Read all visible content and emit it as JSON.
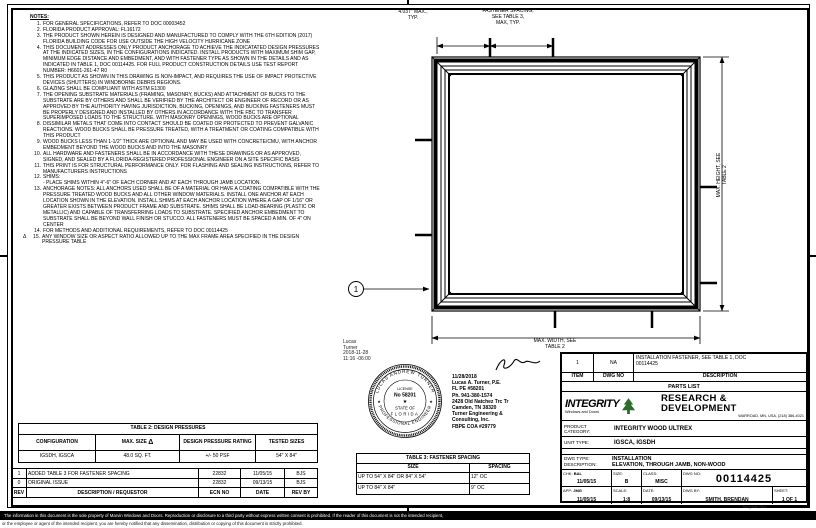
{
  "notes": {
    "title": "NOTES:",
    "items": [
      {
        "num": "1.",
        "text": "FOR GENERAL SPECIFICATIONS, REFER TO DOC 00003452"
      },
      {
        "num": "2.",
        "text": "FLORIDA PRODUCT APPROVAL: FL16172"
      },
      {
        "num": "3.",
        "text": "THE PRODUCT SHOWN HEREIN IS DESIGNED AND MANUFACTURED TO COMPLY WITH THE 6TH EDITION (2017) FLORIDA BUILDING CODE FOR USE OUTSIDE THE HIGH VELOCITY HURRICANE ZONE"
      },
      {
        "num": "4.",
        "text": "THIS DOCUMENT ADDRESSES ONLY PRODUCT ANCHORAGE TO ACHIEVE THE INDICATATED DESIGN PRESSURES AT THE INDICATED SIZES, IN THE CONFIGURATIONS INDICATED. INSTALL PRODUCTS WITH MAXIMUM SHIM GAP, MINIMUM EDGE DISTANCE AND EMBEDMENT, AND WITH FASTENER TYPE AS SHOWN IN THE DETAILS AND AS INDICATED IN TABLE 1, DOC 00114425. FOR FULL PRODUCT CONSTRUCTION DETAILS USE TEST REPORT NUMBER: H6601-261-47 R0"
      },
      {
        "num": "5.",
        "text": "THIS PRODUCT AS SHOWN IN THIS DRAWING IS NON-IMPACT, AND REQUIRES THE USE OF IMPACT PROTECTIVE DEVICES (SHUTTERS) IN WINDBORNE DEBRIS REGIONS."
      },
      {
        "num": "6.",
        "text": "GLAZING SHALL BE COMPLIANT WITH ASTM E1300"
      },
      {
        "num": "7.",
        "text": "THE OPENING SUBSTRATE MATERIALS (FRAMING, MASONRY, BUCKS) AND ATTACHMENT OF BUCKS TO THE SUBSTRATE ARE BY OTHERS AND SHALL BE VERIFIED BY THE ARCHITECT OR ENGINEER OF RECORD OR AS APPROVED BY THE AUTHORITY HAVING JURISDICTION. BUCKING, OPENINGS, AND BUCKING FASTENERS MUST BE PROPERLY DESIGNED AND INSTALLED BY OTHERS IN ACCORDANCE WITH THE FBC TO TRANSFER SUPERIMPOSED LOADS TO THE STRUCTURE. WITH MASONRY OPENINGS, WOOD BUCKS ARE OPTIONAL"
      },
      {
        "num": "8.",
        "text": "DISSIMILAR METALS THAT COME INTO CONTACT SHOULD BE COATED OR PROTECTED TO PREVENT GALVANIC REACTIONS. WOOD BUCKS SHALL BE PRESSURE TREATED, WITH A TREATMENT OR COATING COMPATIBLE WITH THIS PRODUCT"
      },
      {
        "num": "9.",
        "text": "WOOD BUCKS LESS THAN 1-1/2\" THICK ARE OPTIONAL AND MAY BE USED WITH CONCRETE/CMU, WITH ANCHOR EMBEDMENT BEYOND THE WOOD BUCKS AND INTO THE MASONRY"
      },
      {
        "num": "10.",
        "text": "ALL HARDWARE AND FASTENERS SHALL BE IN ACCORDANCE WITH THESE DRAWINGS OR AS APPROVED, SIGNED, AND SEALED BY A FLORIDA-REGISTERED PROFESSIONAL ENGINEER ON A SITE SPECIFIC BASIS"
      },
      {
        "num": "11.",
        "text": "THIS PRINT IS FOR STRUCTURAL PERFORMANCE ONLY. FOR FLASHING AND SEALING INSTRUCTIONS, REFER TO MANUFACTURERS INSTRUCTIONS"
      },
      {
        "num": "12.",
        "text": "SHIMS:\n- PLACE SHIMS WITHIN 4\"-6\" OF EACH CORNER AND AT EACH THROUGH JAMB LOCATION."
      },
      {
        "num": "13.",
        "text": "ANCHORAGE NOTES:  ALL ANCHORS USED SHALL BE OF A MATERIAL OR HAVE A COATING COMPATIBLE WITH THE PRESSURE TREATED WOOD BUCKS AND ALL OTHER WINDOW MATERIALS.  INSTALL ONE ANCHOR AT EACH LOCATION SHOWN IN THE ELEVATION. INSTALL SHIMS AT EACH ANCHOR LOCATION WHERE A GAP OF 1/16\" OR GREATER EXISTS BETWEEN PRODUCT FRAME AND SUBSTRATE. SHIMS SHALL BE LOAD-BEARING (PLASTIC OR METALLIC) AND CAPABLE OF TRANSFERRING LOADS TO SUBSTRATE. SPECIFIED ANCHOR EMBEDMENT TO SUBSTRATE SHALL BE BEYOND WALL FINISH OR STUCCO. ALL FASTENERS MUST BE SPACED A MIN. OF 4\" ON CENTER"
      },
      {
        "num": "14.",
        "text": "FOR METHODS AND ADDITIONAL REQUIREMENTS, REFER TO DOC 00114425"
      },
      {
        "num": "15.",
        "marker": "Δ",
        "text": "ANY WINDOW SIZE OR ASPECT RATIO ALLOWED UP TO THE MAX FRAME AREA SPECIFIED IN THE DESIGN PRESSURE TABLE"
      }
    ]
  },
  "elevation": {
    "dim_corner_label": "4.037\" MAX.,\nTYP.",
    "dim_spacing_label": "FASTENER SPACING,\nSEE TABLE 3,\nMAX, TYP.",
    "dim_height_label": "MAX. HEIGHT, SEE\nTABLE 2",
    "dim_width_label": "MAX. WIDTH, SEE\nTABLE 2",
    "balloon_label": "1"
  },
  "table2": {
    "title": "TABLE 2: DESIGN PRESSURES",
    "headers": [
      "CONFIGURATION",
      "MAX. SIZE",
      "DESIGN PRESSURE RATING",
      "TESTED SIZES"
    ],
    "header_marker": "Δ",
    "row": [
      "IGSDH, IGSCA",
      "48.0 SQ. FT.",
      "+/- 50 PSF",
      "54\" X 84\""
    ]
  },
  "revisions": {
    "headers": [
      "REV",
      "DESCRIPTION / REQUESTOR",
      "ECN NO",
      "DATE",
      "REV BY"
    ],
    "rows": [
      {
        "rev": "1",
        "desc": "ADDED TABLE 3 FOR FASTENER SPACING",
        "ecn": "22832",
        "date": "11/05/15",
        "by": "BJS"
      },
      {
        "rev": "0",
        "desc": "ORIGINAL ISSUE",
        "ecn": "22832",
        "date": "09/13/15",
        "by": "BJS"
      }
    ]
  },
  "table3": {
    "title": "TABLE 3: FASTENER SPACING",
    "headers": [
      "SIZE",
      "SPACING"
    ],
    "rows": [
      [
        "UP TO 54\" X 84\" OR 84\" X 54\"",
        "12\" OC"
      ],
      [
        "UP TO 84\" X 84\"",
        "9\" OC"
      ]
    ]
  },
  "stamp": {
    "digital_signature": "Lucas\nTurner\n2018-11-28\n11:16 -06:00",
    "seal_top": "LUCAS ANDREW TURNER",
    "seal_bottom": "PROFESSIONAL ENGINEER",
    "seal_license_label": "LICENSE",
    "seal_license_no": "No 58201",
    "seal_star": "★",
    "seal_state": "STATE OF",
    "seal_florida": "FLORIDA"
  },
  "engineer": {
    "info": "11/28/2018\nLucas A. Turner, P.E.\nFL PE #58201\nPh. 941-380-1574\n2428 Old Natchez Trc Tr\nCamden, TN 38320\nTurner Engineering &\nConsulting, Inc.\nFBPE COA #29779"
  },
  "parts_list": {
    "title": "PARTS LIST",
    "headers": [
      "ITEM",
      "DWG NO",
      "DESCRIPTION"
    ],
    "row": {
      "item": "1",
      "dwg_no": "NA",
      "description": "INSTALLATION FASTENER, SEE TABLE 1, DOC\n00114425"
    }
  },
  "title_block": {
    "brand_name": "INTEGRITY",
    "brand_sub": "Windows and Doors",
    "dept": "RESEARCH & DEVELOPMENT",
    "dept_address": "WARROAD, MN, USA, (218) 386-4021",
    "product_category_label": "PRODUCT CATEGORY:",
    "product_category": "INTEGRITY WOOD ULTREX",
    "unit_type_label": "UNIT TYPE:",
    "unit_type": "IGSCA, IGSDH",
    "dwg_type_label": "DWG TYPE:",
    "dwg_type": "INSTALLATION",
    "description_label": "DESCRIPTION:",
    "description": "ELEVATION, THROUGH JAMB, NON-WOOD",
    "chk_label": "CHK:",
    "chk": "BAL",
    "chk_date": "11/05/15",
    "app_label": "APP:",
    "app": "JMG",
    "app_date": "11/05/15",
    "size_label": "SIZE:",
    "size": "B",
    "scale_label": "SCALE:",
    "scale": "1:8",
    "class_label": "CLASS:",
    "class": "MISC",
    "date_label": "DATE:",
    "date": "09/13/15",
    "dwg_no_label": "DWG NO:",
    "dwg_no": "00114425",
    "dwg_by_label": "DWG BY:",
    "dwg_by": "SMITH, BRENDAN",
    "sheet_label": "SHEET:",
    "sheet": "1 OF 1",
    "template_note": "Template Rev"
  },
  "footer": {
    "bar_text": "The information in this document is the sole property of Marvin Windows and Doors. Reproduction or disclosure to a third party without express written consent is prohibited. If the reader of this document is not the intended recipient,",
    "line2": "or the employee or agent of the intended recipient, you are hereby notified that any dissemination, distribution or copying of this document is strictly prohibited."
  },
  "colors": {
    "ink": "#000000",
    "logo_green": "#2d6b2d"
  }
}
